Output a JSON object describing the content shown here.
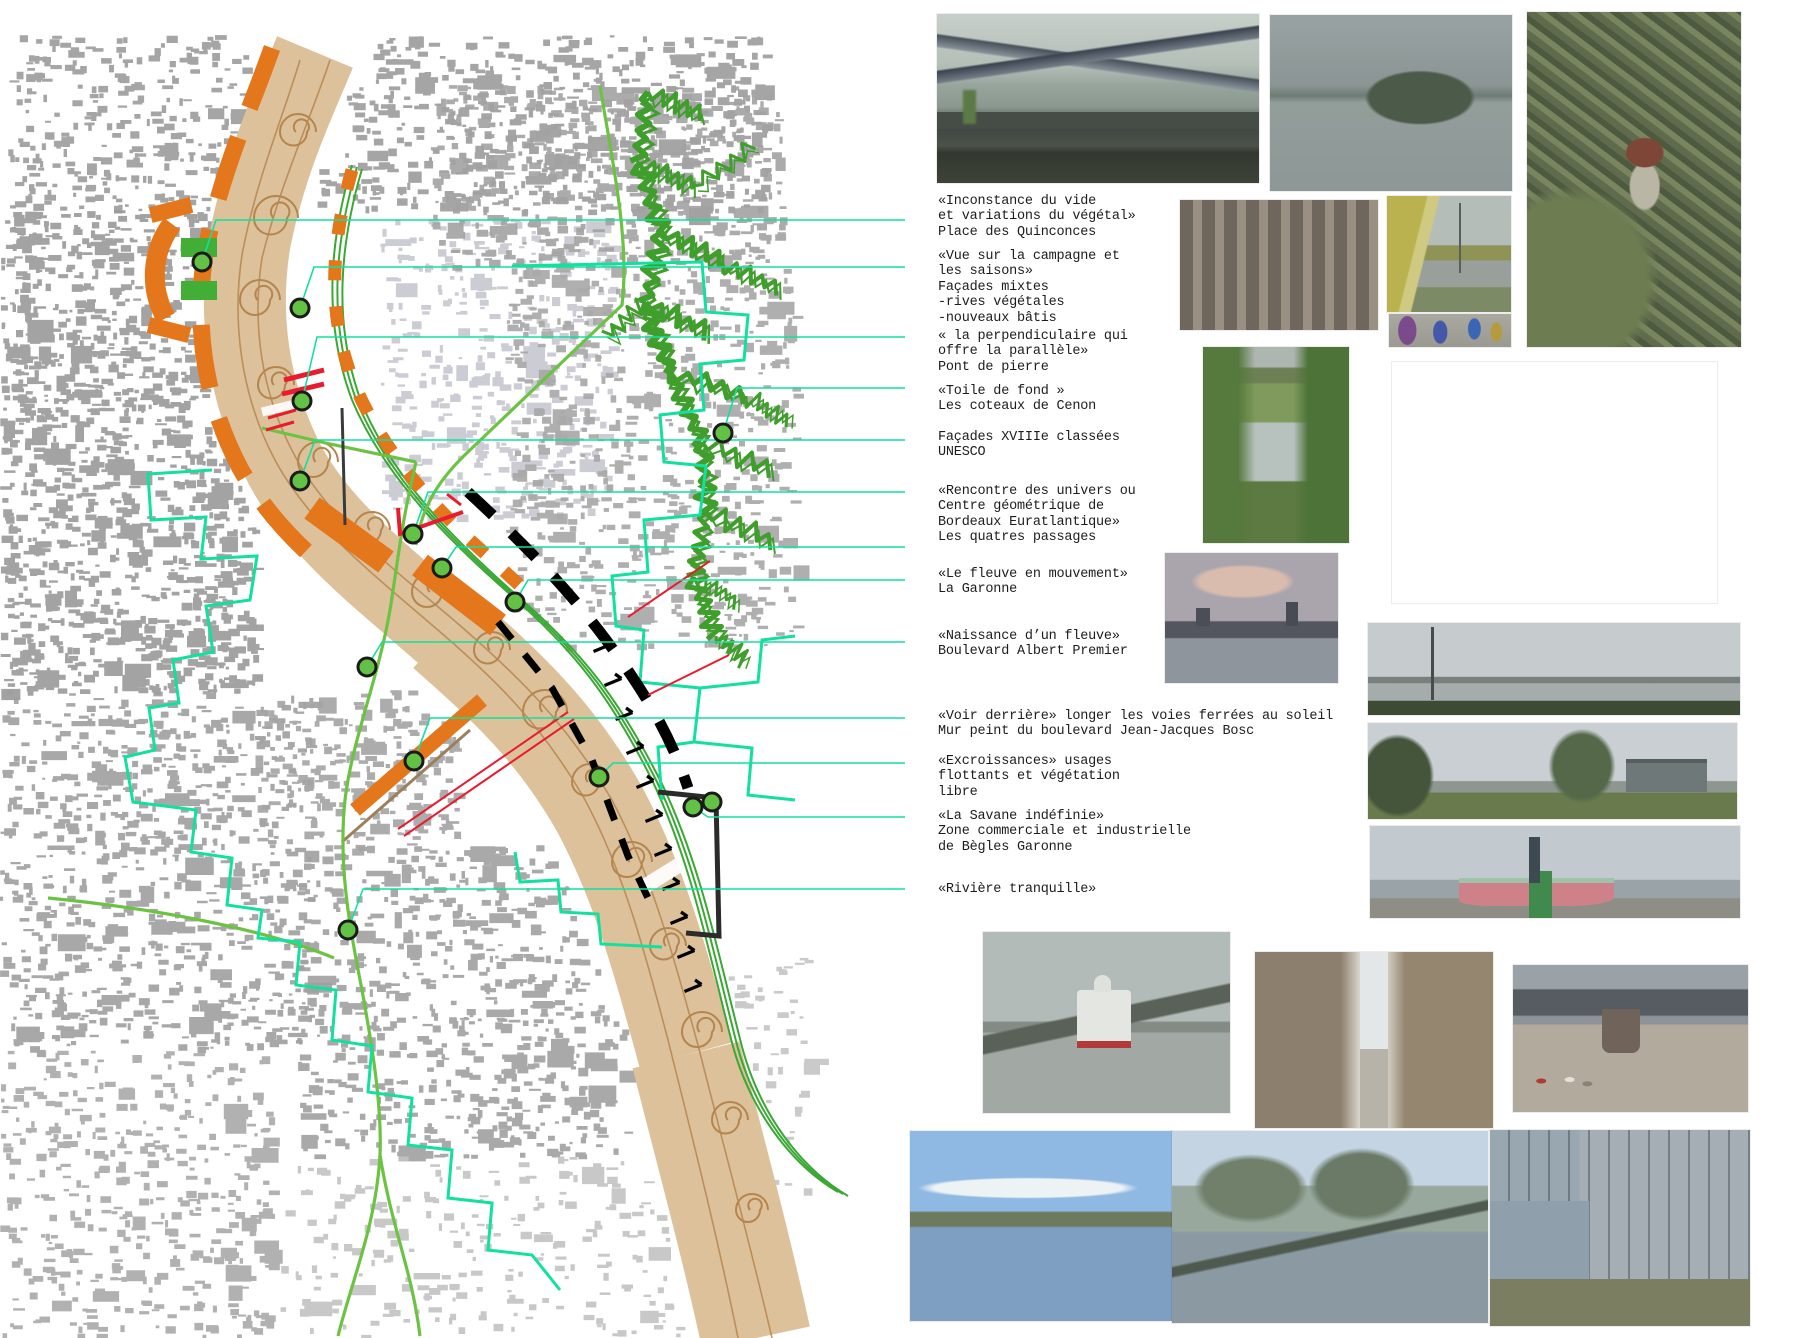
{
  "board": {
    "kind": "urban-analysis-board",
    "city_map": "Bordeaux Garonne sequence map"
  },
  "colors": {
    "orange": "#e4761b",
    "greenbar": "#43ae35",
    "dot_fill": "#63c145",
    "dot_ring": "#1b1b1b",
    "cyan": "#12e09e",
    "road": "#6cc243",
    "coteaux": "#3f9e2c",
    "river": "#dcc19b",
    "riverline": "#b5854f",
    "red": "#e81c2e",
    "black": "#111111",
    "building_gray": "#9b9b9b",
    "building_light": "#c7c7cf",
    "text": "#1c1c1c"
  },
  "annotations": [
    {
      "id": "inconstance",
      "x": 938,
      "y": 194,
      "text": "«Inconstance du vide\net variations du végétal»\nPlace des Quinconces",
      "leaders": [
        [
          [
            202,
            262
          ],
          [
            216,
            220
          ],
          [
            905,
            220
          ]
        ]
      ]
    },
    {
      "id": "vue",
      "x": 938,
      "y": 249,
      "text": "«Vue sur la campagne et\nles saisons»\nFaçades mixtes\n-rives végétales\n-nouveaux bâtis",
      "leaders": [
        [
          [
            300,
            308
          ],
          [
            314,
            267
          ],
          [
            905,
            267
          ]
        ]
      ]
    },
    {
      "id": "perpendiculaire",
      "x": 938,
      "y": 329,
      "text": "« la perpendiculaire qui\noffre la parallèle»\nPont de pierre",
      "leaders": [
        [
          [
            302,
            401
          ],
          [
            317,
            337
          ],
          [
            905,
            337
          ]
        ]
      ]
    },
    {
      "id": "toile",
      "x": 938,
      "y": 384,
      "text": "«Toile de fond »\nLes coteaux de Cenon",
      "leaders": [
        [
          [
            723,
            433
          ],
          [
            737,
            388
          ],
          [
            905,
            388
          ]
        ]
      ]
    },
    {
      "id": "facades",
      "x": 938,
      "y": 430,
      "text": "Façades XVIIIe classées\nUNESCO",
      "leaders": [
        [
          [
            300,
            481
          ],
          [
            315,
            440
          ],
          [
            905,
            440
          ]
        ]
      ]
    },
    {
      "id": "rencontre",
      "x": 938,
      "y": 484,
      "text": "«Rencontre des univers ou\nCentre géométrique de\nBordeaux Euratlantique»\nLes quatres passages",
      "leaders": [
        [
          [
            413,
            534
          ],
          [
            428,
            492
          ],
          [
            905,
            492
          ]
        ]
      ]
    },
    {
      "id": "fleuve",
      "x": 938,
      "y": 567,
      "text": "«Le fleuve en mouvement»\nLa Garonne",
      "leaders": [
        [
          [
            442,
            568
          ],
          [
            456,
            547
          ],
          [
            905,
            547
          ]
        ],
        [
          [
            515,
            602
          ],
          [
            528,
            580
          ],
          [
            905,
            580
          ]
        ]
      ]
    },
    {
      "id": "naissance",
      "x": 938,
      "y": 629,
      "text": "«Naissance d’un fleuve»\nBoulevard Albert Premier",
      "leaders": [
        [
          [
            367,
            667
          ],
          [
            382,
            642
          ],
          [
            905,
            642
          ]
        ]
      ]
    },
    {
      "id": "voir",
      "x": 938,
      "y": 709,
      "text": "«Voir derrière» longer les voies ferrées au soleil\nMur peint du boulevard Jean-Jacques Bosc",
      "leaders": [
        [
          [
            414,
            761
          ],
          [
            430,
            718
          ],
          [
            905,
            718
          ]
        ]
      ]
    },
    {
      "id": "excroissances",
      "x": 938,
      "y": 754,
      "text": "«Excroissances» usages\nflottants et végétation\nlibre",
      "leaders": [
        [
          [
            599,
            777
          ],
          [
            613,
            763
          ],
          [
            905,
            763
          ]
        ]
      ]
    },
    {
      "id": "savane",
      "x": 938,
      "y": 809,
      "text": "«La Savane indéfinie»\nZone commerciale et industrielle\nde Bègles Garonne",
      "leaders": [
        [
          [
            693,
            807
          ],
          [
            708,
            817
          ],
          [
            905,
            817
          ]
        ]
      ]
    },
    {
      "id": "riviere",
      "x": 938,
      "y": 882,
      "text": "«Rivière tranquille»",
      "leaders": [
        [
          [
            348,
            930
          ],
          [
            363,
            889
          ],
          [
            905,
            889
          ]
        ]
      ]
    }
  ],
  "map": {
    "dots": [
      [
        202,
        262
      ],
      [
        300,
        308
      ],
      [
        302,
        401
      ],
      [
        300,
        481
      ],
      [
        413,
        534
      ],
      [
        442,
        568
      ],
      [
        515,
        602
      ],
      [
        367,
        667
      ],
      [
        414,
        761
      ],
      [
        599,
        777
      ],
      [
        693,
        807
      ],
      [
        712,
        802
      ],
      [
        348,
        930
      ],
      [
        723,
        433
      ]
    ],
    "arrows": [
      [
        602,
        648
      ],
      [
        613,
        682
      ],
      [
        624,
        716
      ],
      [
        635,
        750
      ],
      [
        645,
        784
      ],
      [
        654,
        818
      ],
      [
        663,
        852
      ],
      [
        671,
        886
      ],
      [
        679,
        920
      ],
      [
        686,
        954
      ],
      [
        693,
        988
      ]
    ]
  },
  "photos": [
    {
      "name": "bridges",
      "x": 937,
      "y": 14,
      "w": 322,
      "h": 169
    },
    {
      "name": "river-wide",
      "x": 1270,
      "y": 15,
      "w": 242,
      "h": 176
    },
    {
      "name": "forest-tower",
      "x": 1527,
      "y": 12,
      "w": 214,
      "h": 335
    },
    {
      "name": "pont-pierre",
      "x": 1180,
      "y": 200,
      "w": 198,
      "h": 130
    },
    {
      "name": "rail-mural",
      "x": 1387,
      "y": 196,
      "w": 124,
      "h": 116
    },
    {
      "name": "graffiti",
      "x": 1389,
      "y": 314,
      "w": 122,
      "h": 33
    },
    {
      "name": "marsh",
      "x": 1203,
      "y": 347,
      "w": 146,
      "h": 196
    },
    {
      "name": "coteaux-view",
      "x": 1392,
      "y": 362,
      "w": 325,
      "h": 241
    },
    {
      "name": "dusk-skyline",
      "x": 1165,
      "y": 553,
      "w": 173,
      "h": 130
    },
    {
      "name": "pano-lamppost",
      "x": 1368,
      "y": 623,
      "w": 372,
      "h": 92
    },
    {
      "name": "pano-shed",
      "x": 1368,
      "y": 723,
      "w": 369,
      "h": 96
    },
    {
      "name": "pano-boat",
      "x": 1370,
      "y": 826,
      "w": 370,
      "h": 92
    },
    {
      "name": "boat-quay",
      "x": 983,
      "y": 932,
      "w": 247,
      "h": 181
    },
    {
      "name": "street-alley",
      "x": 1255,
      "y": 952,
      "w": 238,
      "h": 176
    },
    {
      "name": "under-bridge",
      "x": 1513,
      "y": 965,
      "w": 235,
      "h": 147
    },
    {
      "name": "strip-blue",
      "x": 910,
      "y": 1131,
      "w": 262,
      "h": 190
    },
    {
      "name": "strip-flooded",
      "x": 1172,
      "y": 1131,
      "w": 316,
      "h": 192
    },
    {
      "name": "strip-shed",
      "x": 1490,
      "y": 1130,
      "w": 260,
      "h": 196
    }
  ]
}
